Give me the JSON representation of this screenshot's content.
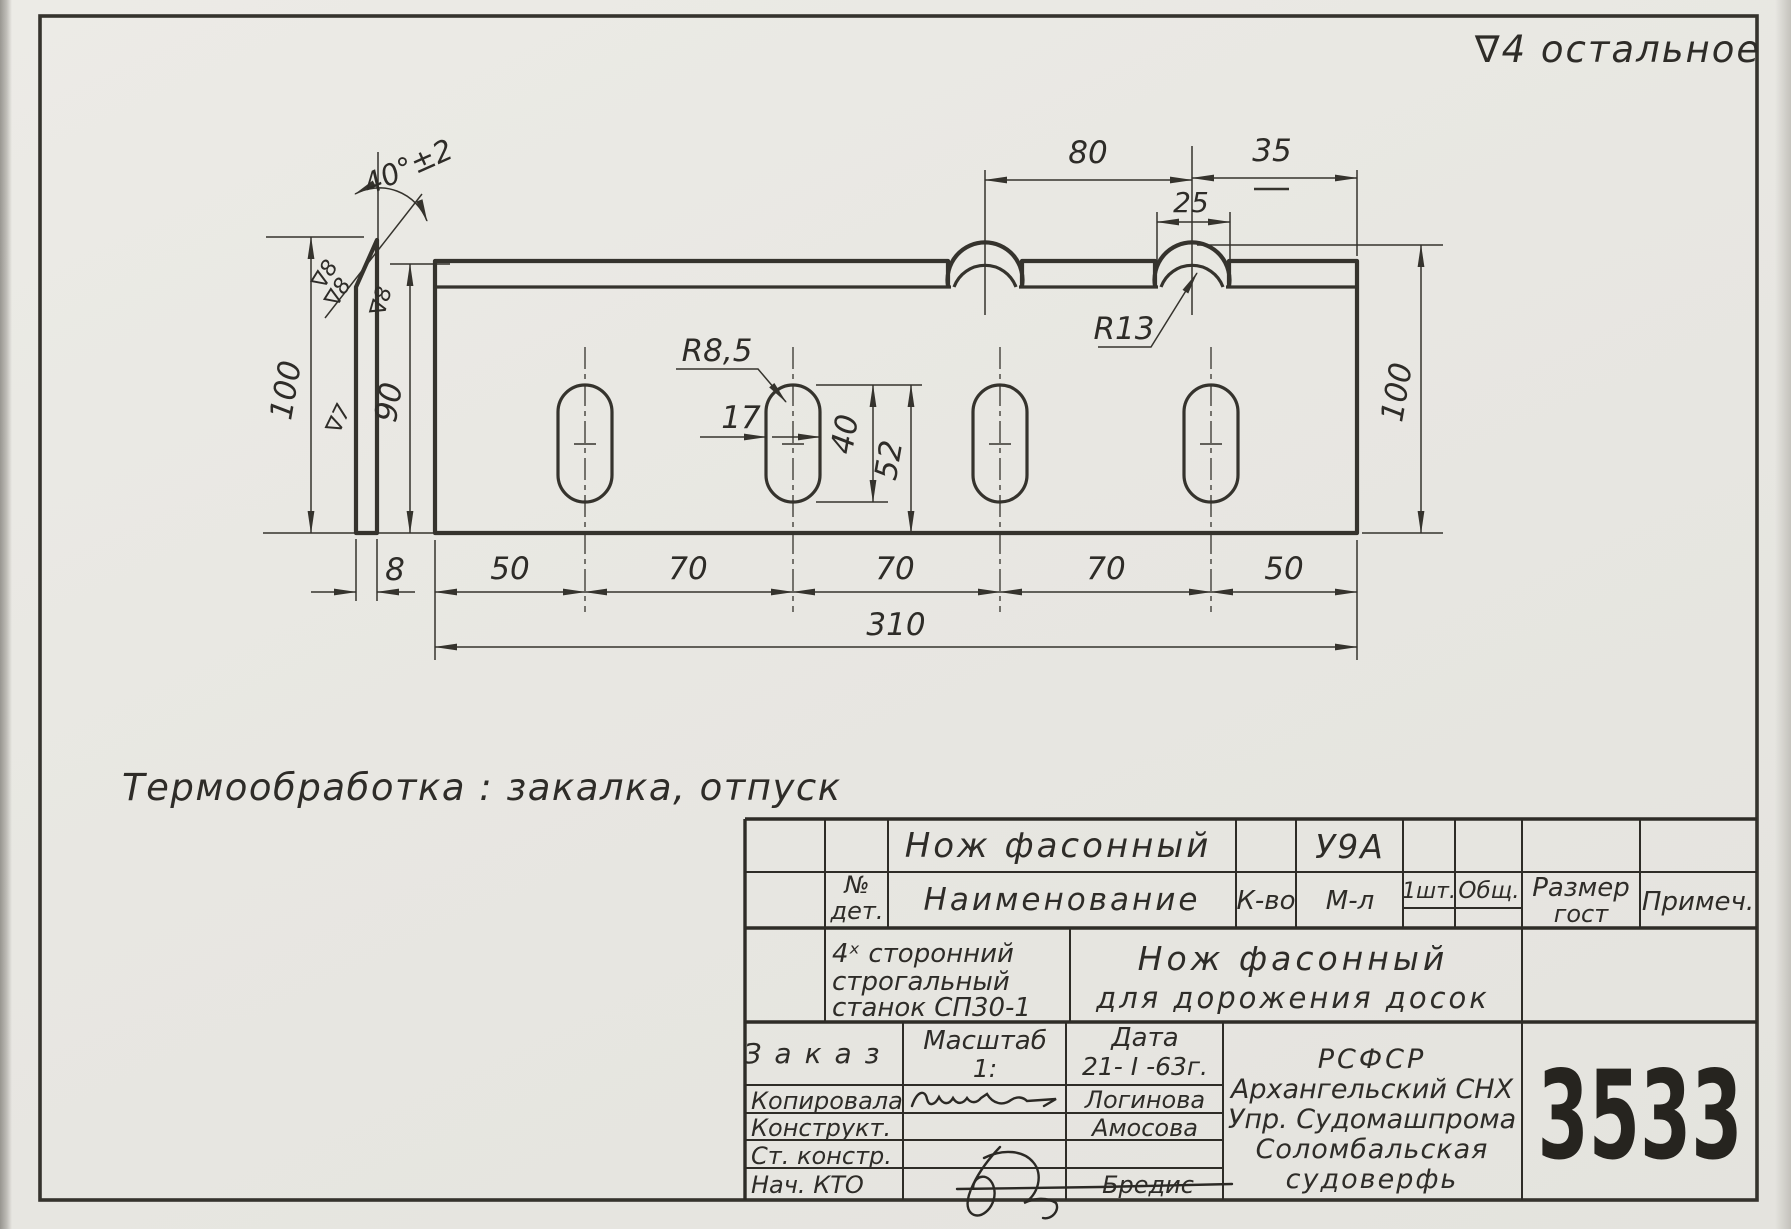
{
  "colors": {
    "paper": "#e8e7e2",
    "ink": "#35332d",
    "number_ink": "#26241f"
  },
  "annotations": {
    "surface_finish": "∇4 остальное",
    "heat_treatment": "Термообработка : закалка, отпуск"
  },
  "front_view": {
    "dim_hump_spacing": "80",
    "dim_hump_to_edge": "35",
    "dim_notch_width": "25",
    "dim_hump_radius": "R13",
    "dim_slot_radius": "R8,5",
    "dim_slot_width": "17",
    "dim_slot_length": "40",
    "dim_slot_bottom_offset": "52",
    "dim_seg_1": "50",
    "dim_seg_2": "70",
    "dim_seg_3": "70",
    "dim_seg_4": "70",
    "dim_seg_5": "50",
    "dim_total_length": "310",
    "dim_height_right": "100"
  },
  "side_view": {
    "dim_angle": "40°±2",
    "dim_height": "100",
    "dim_face_height": "90",
    "dim_thickness": "8",
    "finish_bevel_1": "∇8",
    "finish_bevel_2": "∇8",
    "finish_edge": "∇8",
    "finish_face": "∇7"
  },
  "title_block": {
    "part_name": "Нож фасонный",
    "material_grade": "У9А",
    "headers": {
      "det_no_1": "№",
      "det_no_2": "дет.",
      "name": "Наименование",
      "qty": "К-во",
      "material": "М-л",
      "per_item": "1шт.",
      "total": "Общ.",
      "size_1": "Размер",
      "size_2": "гост",
      "note": "Примеч."
    },
    "machine_line1": "4ˣ сторонний",
    "machine_line2": "строгальный",
    "machine_line3": "станок СП30-1",
    "purpose_line1": "Нож фасонный",
    "purpose_line2": "для дорожения досок",
    "order_label": "Заказ",
    "scale_label": "Масштаб",
    "scale_value": "1:",
    "date_label": "Дата",
    "date_value": "21- I -63г.",
    "rows": {
      "copied_label": "Копировала",
      "copied_name": "Логинова",
      "designer_label": "Конструкт.",
      "designer_name": "Амосова",
      "senior_label": "Ст. констр.",
      "chief_label": "Нач. КТО",
      "chief_name": "Бредис"
    },
    "organization": [
      "РСФСР",
      "Архангельский СНХ",
      "Упр. Судомашпрома",
      "Соломбальская",
      "судоверфь"
    ],
    "drawing_number": "3533"
  }
}
